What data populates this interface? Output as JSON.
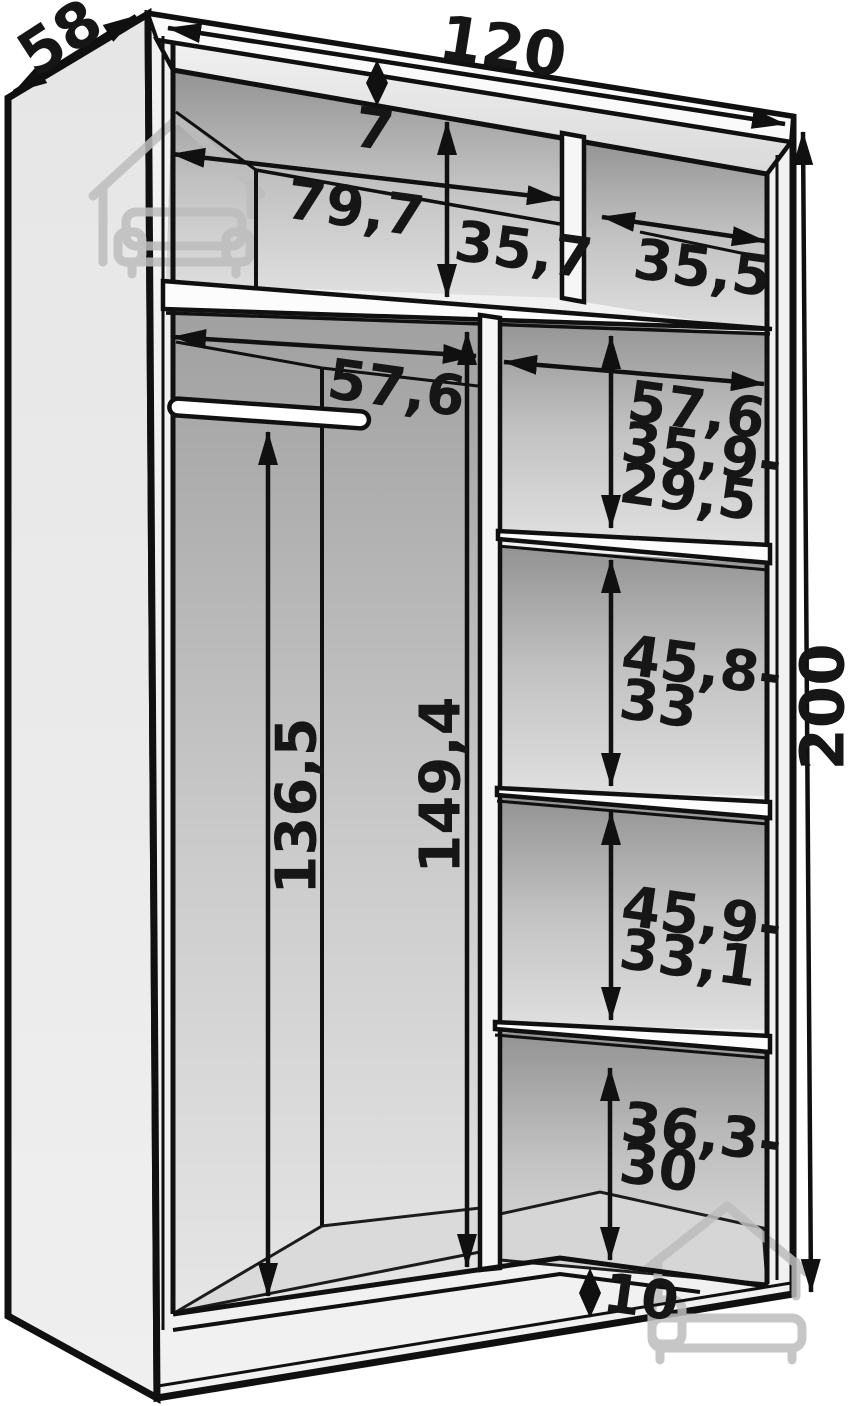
{
  "diagram": {
    "kind": "wardrobe-interior-dimension-drawing",
    "labels": {
      "depth": "58",
      "width": "120",
      "height": "200",
      "top_panel_gap": "7",
      "top_left_width": "79,7",
      "top_left_height": "35,7",
      "top_right_width": "35,5",
      "left_bay_width": "57,6",
      "right_bay_width": "57,6",
      "gap1_line1": "35,9-",
      "gap1_line2": "29,5",
      "gap2_line1": "45,8-",
      "gap2_line2": "33",
      "gap3_line1": "45,9-",
      "gap3_line2": "33,1",
      "gap4_line1": "36,3-",
      "gap4_line2": "30",
      "hanging_height": "136,5",
      "divider_height": "149,4",
      "plinth_height": "10"
    },
    "colors": {
      "line": "#101010",
      "panel_light": "#eeeeee",
      "interior_dark": "#9a9a9a",
      "watermark": "#bdbdbd"
    }
  }
}
